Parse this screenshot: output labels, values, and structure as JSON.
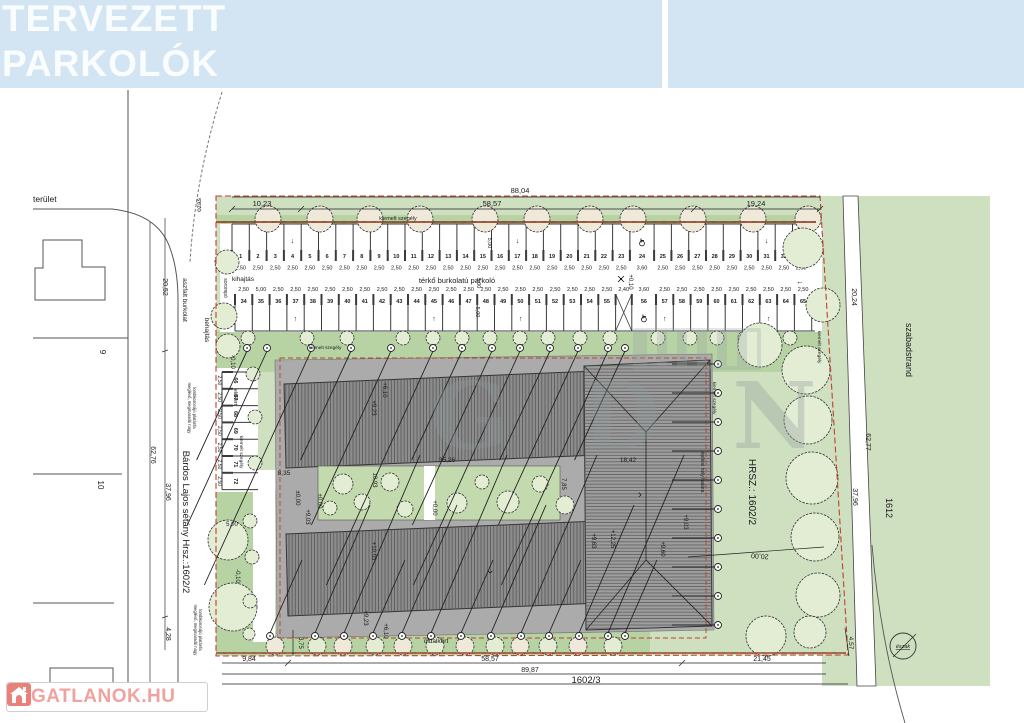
{
  "header": {
    "line1": "TERVEZETT",
    "line2": "PARKOLÓK"
  },
  "watermark": {
    "text": "GDN"
  },
  "logo": {
    "brand": "INGATLANOK.HU"
  },
  "labels": {
    "terulet": "terület",
    "ozas": "ozás",
    "aszfalt": "aszfalt burkolat",
    "street": "Bárdos Lajos sétány Hrsz.:1602/2",
    "parcel9": "9",
    "parcel10": "10",
    "kihajtas": "kihajtás",
    "behajtas": "behajtás",
    "sorompo": "sorompó",
    "terko": "térkő burkolatú parkoló",
    "kiemelt": "kiemelt szegély",
    "elokert": "előkert",
    "oldalkert": "oldalkert",
    "epitesi": "építési hely határa",
    "hrsz": "HRSZ.: 1602/2",
    "parcel_bottom": "1602/3",
    "szabadstrand": "szabadstrand",
    "parcel1612": "1612",
    "eszak": "észak",
    "platanfa_l1": "meglévő, megmaradó nagy",
    "platanfa_l2": "lombkoronájú platánfa"
  },
  "dims": {
    "top_total": "88,04",
    "top_left": "10,23",
    "top_mid": "58,57",
    "top_right": "19,24",
    "left_a": "20,52",
    "left_b": "62,76",
    "left_c": "37,96",
    "left_d": "4,28",
    "right_a": "20,24",
    "right_b": "62,77",
    "right_c": "37,96",
    "bottom_a": "9,84",
    "bottom_b": "58,57",
    "bottom_c": "89,87",
    "bottom_d": "21,45",
    "bottom_e": "4,57",
    "bottom_f": "20,00",
    "bottom_g": "3,75",
    "bld_a": "8,35",
    "bld_b": "10,93",
    "bld_c": "35,26",
    "bld_d": "18,42",
    "bld_e": "7,85",
    "depth": "5,00"
  },
  "elev": {
    "p610": "+6,10",
    "p923": "+9,23",
    "z00": "±0,00",
    "p000": "+0,00",
    "p903": "+9,03",
    "p1003": "+10,03",
    "p1225": "+12,25",
    "p960": "+9,60",
    "p963": "+9,63",
    "p010": "+0,10",
    "m010": "-0,10",
    "d500": "5,00"
  },
  "parking": {
    "surface_label": "térkő burkolatú parkoló",
    "stall_dim_default": "2,50",
    "row1": {
      "numbers": [
        "1",
        "2",
        "3",
        "4",
        "5",
        "6",
        "7",
        "8",
        "9",
        "10",
        "11",
        "12",
        "13",
        "14",
        "15",
        "16",
        "17",
        "18",
        "19",
        "20",
        "21",
        "22",
        "23",
        "24",
        "25",
        "26",
        "27",
        "28",
        "29",
        "30",
        "31",
        "32",
        "33"
      ],
      "width_default": "2,50",
      "width_overrides": {
        "24": "3,60"
      },
      "accessible": [
        "24"
      ],
      "arrows_down": [
        "4",
        "17",
        "31"
      ]
    },
    "row2": {
      "numbers": [
        "34",
        "35",
        "36",
        "37",
        "38",
        "39",
        "40",
        "41",
        "42",
        "43",
        "44",
        "45",
        "46",
        "47",
        "48",
        "49",
        "50",
        "51",
        "52",
        "53",
        "54",
        "55",
        "x",
        "56",
        "57",
        "58",
        "59",
        "60",
        "61",
        "62",
        "63",
        "64",
        "65"
      ],
      "width_default": "2,50",
      "width_overrides": {
        "35": "5,00",
        "x": "2,40",
        "56": "3,60"
      },
      "accessible": [
        "56"
      ],
      "arrows_up": [
        "37",
        "45",
        "50",
        "57",
        "63"
      ]
    },
    "col": {
      "numbers": [
        "66",
        "67",
        "68",
        "69",
        "70",
        "71",
        "72"
      ],
      "width_default": "2,50"
    }
  },
  "colors": {
    "header_blue": "#d3e4f2",
    "lawn_green": "#cfe0c1",
    "strip_green": "#b7d3a4",
    "tree_green": "#e2edd4",
    "tree_cream": "#efe9da",
    "roof_dark": "#8d8d8d",
    "roof_mid": "#9d9d9d",
    "paving_gray": "#ababab",
    "boundary_red": "#c2402e",
    "curb_brown": "#7a4a2a",
    "logo_red": "#ea8077",
    "logo_pink": "#f0a29e"
  }
}
